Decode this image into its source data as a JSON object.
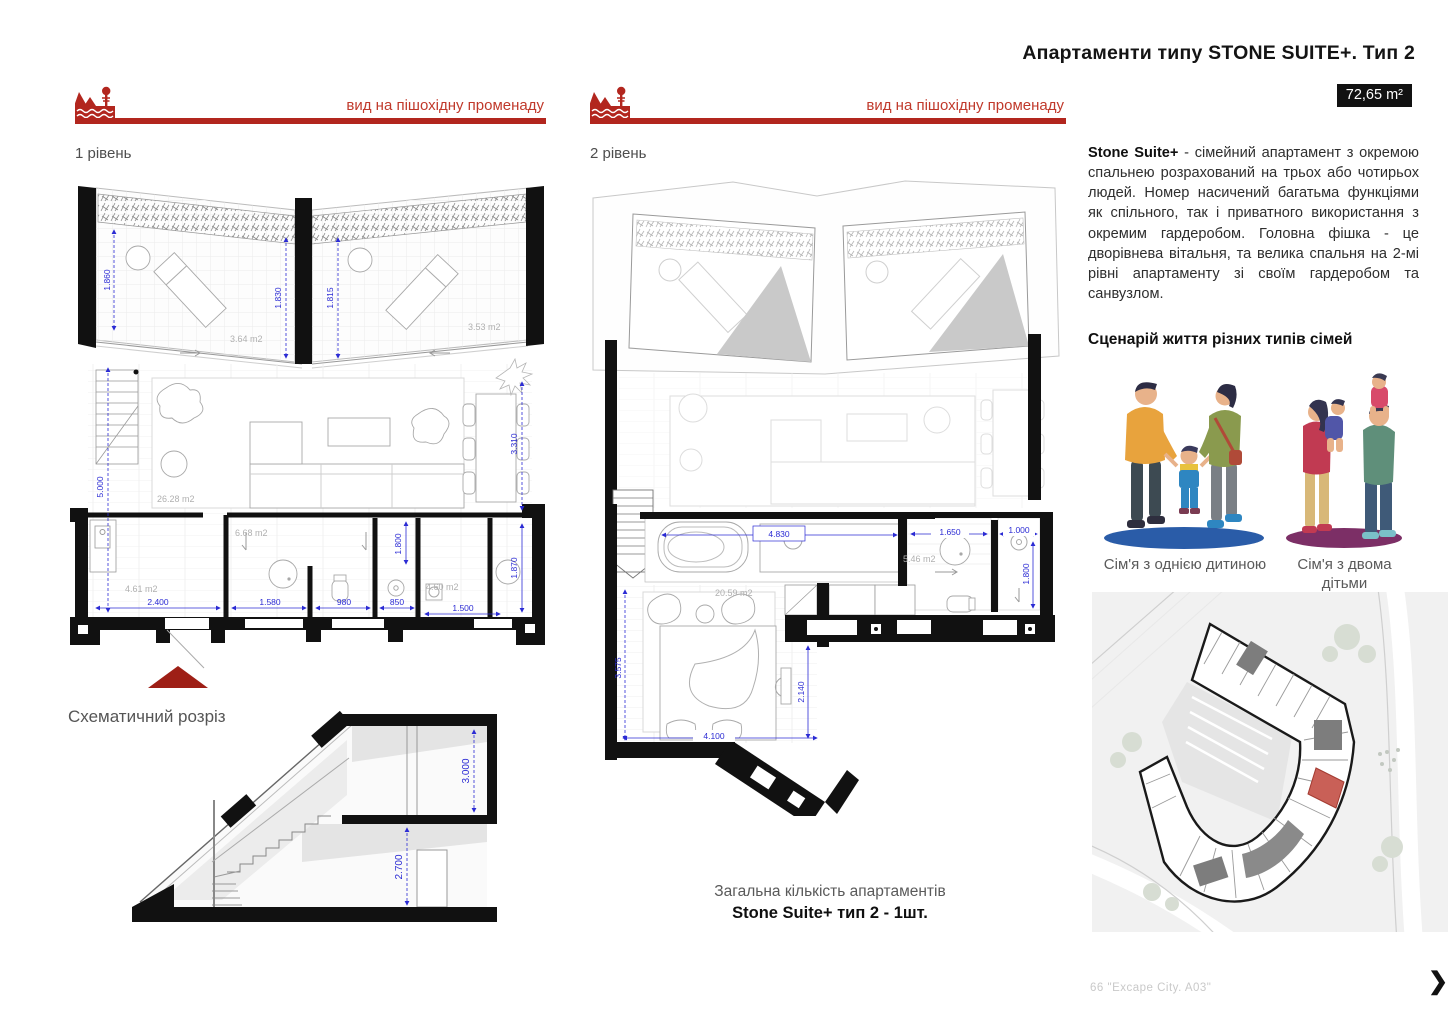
{
  "header": {
    "title": "Апартаменти типу STONE SUITE+. Тип 2",
    "area_badge": "72,65 m²",
    "promenade_label": "вид на пішохідну променаду"
  },
  "colors": {
    "accent_red": "#b2261e",
    "red_text": "#c0392b",
    "dim_blue": "#2b2bd4",
    "wall_black": "#111111",
    "entrance_red": "#9e1f16",
    "highlight_unit_red": "#c96057",
    "shadow_blue": "#2a5ca8",
    "shadow_purple": "#7c2f66"
  },
  "icons": {
    "promenade": "trees-water-icon",
    "next": "chevron-right-icon"
  },
  "plan1": {
    "label": "1 рівень",
    "dims": {
      "terrace_left": "1.860",
      "wing_left": "1.830",
      "wing_right": "1.815",
      "living_height": "5.000",
      "dining": "3.310",
      "hall_width": "2.400",
      "bath_width": "1.580",
      "wc_width": "980",
      "shower_width": "850",
      "bath_depth": "1.800",
      "wardrobe_width": "1.500",
      "wardrobe_depth": "1.870"
    },
    "areas": {
      "terrace_left": "3.64 m2",
      "terrace_right": "3.53 m2",
      "living": "26.28 m2",
      "hall": "4.61 m2",
      "bath": "6.68 m2",
      "utility": "4.60 m2"
    }
  },
  "plan2": {
    "label": "2 рівень",
    "dims": {
      "bath_width": "4.830",
      "shower_width": "1.650",
      "wardrobe_width": "1.000",
      "wardrobe_depth": "1.800",
      "bedroom_depth": "3.575",
      "corridor": "2.140",
      "bed_width": "4.100"
    },
    "areas": {
      "shower": "5.46 m2",
      "bedroom": "20.59 m2"
    }
  },
  "section": {
    "label": "Схематичний розріз",
    "upper_height": "3.000",
    "lower_height": "2.700"
  },
  "description": {
    "lead": "Stone Suite+",
    "body": " - сімейний апартамент з окремою спальнею розрахований на трьох або чотирьох людей. Номер насичений багатьма функціями як спільного, так і приватного використання з окремим гардеробом. Головна фішка - це дворівнева вітальня, та велика спальня на 2-мі рівні апартаменту зі своїм гардеробом та санвузлом.",
    "scenario_heading": "Сценарій життя різних типів сімей"
  },
  "families": {
    "one_child_caption": "Сім'я з однією дитиною",
    "two_children_caption": "Сім'я з двома дітьми"
  },
  "totals": {
    "line1": "Загальна кількість апартаментів",
    "line2": "Stone Suite+ тип 2 - 1шт."
  },
  "footer": {
    "page_note": "66 \"Excape City. A03\"",
    "next_glyph": "❯"
  }
}
